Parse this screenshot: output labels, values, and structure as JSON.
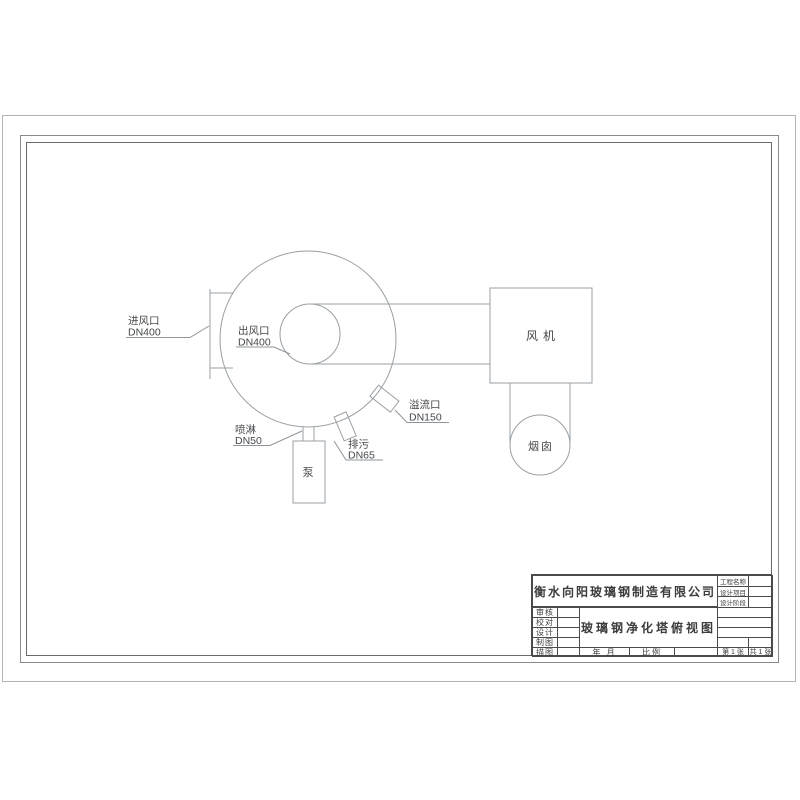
{
  "drawing": {
    "equipment": {
      "fan": "风机",
      "pump": "泵",
      "chimney": "烟囱"
    },
    "nozzles": {
      "inlet": {
        "name": "进风口",
        "dn": "DN400"
      },
      "outlet": {
        "name": "出风口",
        "dn": "DN400"
      },
      "spray": {
        "name": "喷淋",
        "dn": "DN50"
      },
      "drain": {
        "name": "排污",
        "dn": "DN65"
      },
      "overflow": {
        "name": "溢流口",
        "dn": "DN150"
      }
    }
  },
  "title_block": {
    "company": "衡水向阳玻璃钢制造有限公司",
    "drawing_title": "玻璃钢净化塔俯视图",
    "project_labels": [
      "工程名称",
      "设计项目",
      "设计阶段"
    ],
    "role_labels": [
      "审核",
      "校对",
      "设计",
      "制图",
      "描图"
    ],
    "date_label": "年 月",
    "scale_label": "比例",
    "sheet_label": "第 1 张",
    "total_label": "共 1 张"
  },
  "colors": {
    "paper": "#ffffff",
    "drawing_line": "#9aa0a4",
    "frame_line": "#6a6a6a",
    "text": "#3c3c3c"
  }
}
